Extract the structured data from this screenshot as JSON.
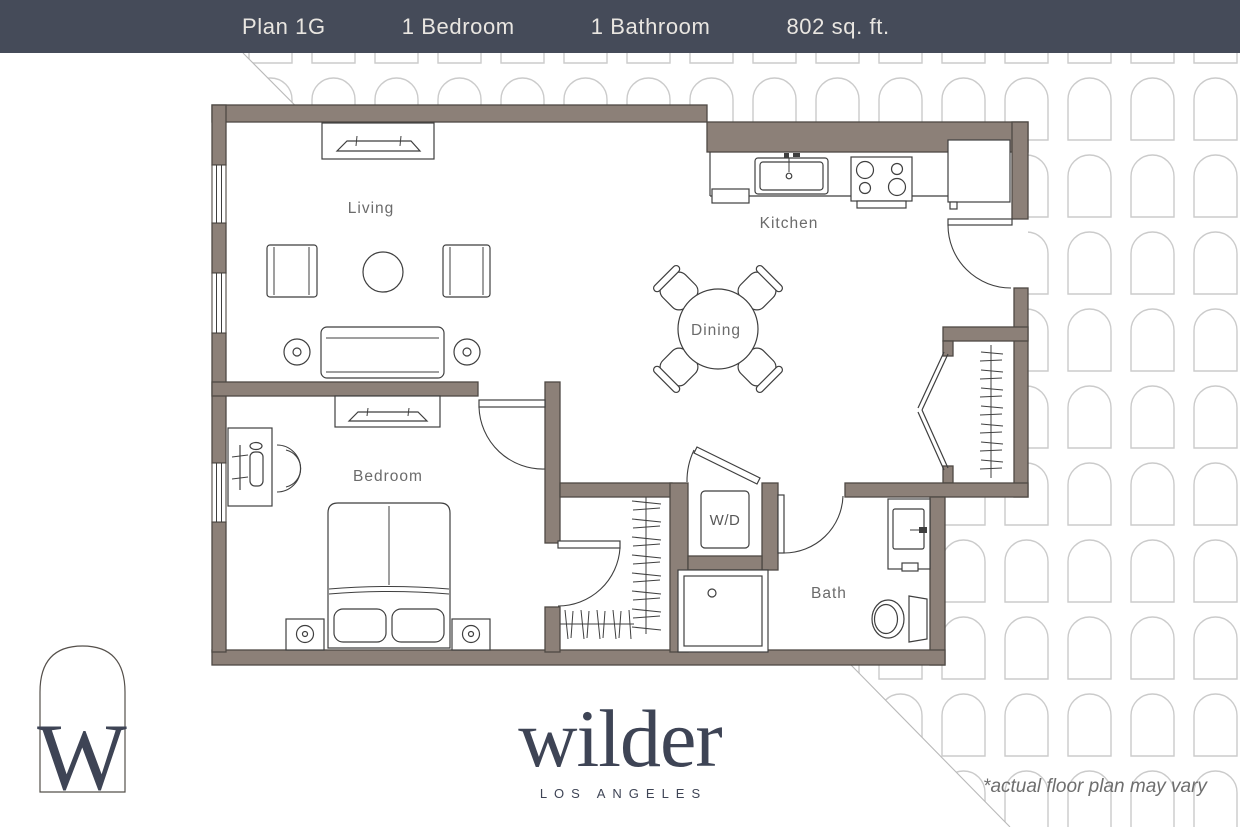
{
  "header": {
    "items": [
      {
        "label": "Plan 1G"
      },
      {
        "label": "1 Bedroom"
      },
      {
        "label": "1 Bathroom"
      },
      {
        "label": "802 sq. ft."
      }
    ]
  },
  "rooms": {
    "living": "Living",
    "kitchen": "Kitchen",
    "dining": "Dining",
    "bedroom": "Bedroom",
    "laundry": "W/D",
    "bath": "Bath"
  },
  "branding": {
    "monogram": "W",
    "name": "wilder",
    "city": "LOS ANGELES"
  },
  "footnote": "*actual floor plan may vary",
  "theme": {
    "header_bg": "#454B59",
    "header_text": "#E9E6E1",
    "wall": "#8C8078",
    "wall_edge": "#4E4944",
    "line": "#3F3F3F",
    "label": "#6B6B6B",
    "brand": "#3E4455",
    "pattern": "#CBCBCB",
    "diagonal": "#B9B9B9"
  }
}
